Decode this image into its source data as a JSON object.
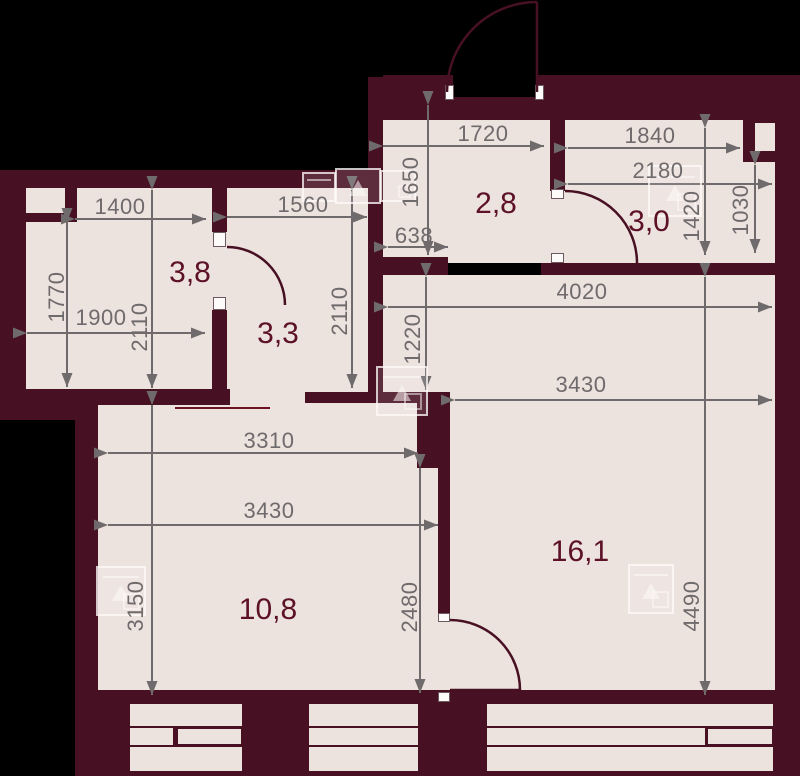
{
  "plan_title": "apartment-floor-plan",
  "colors": {
    "background": "#000000",
    "wall": "#471023",
    "room_fill": "#ece2de",
    "dimension_gray": "#6f6a6c",
    "room_label_red": "#5c1127",
    "door_frame_white": "#fdfbfa"
  },
  "rooms": {
    "r38": "3,8",
    "r33": "3,3",
    "r28": "2,8",
    "r30": "3,0",
    "r161": "16,1",
    "r108": "10,8"
  },
  "dims": {
    "d1400": "1400",
    "d1560": "1560",
    "d1900": "1900",
    "d1770": "1770",
    "d2110_a": "2110",
    "d2110_b": "2110",
    "d1720": "1720",
    "d1650": "1650",
    "d638": "638",
    "d1840": "1840",
    "d2180": "2180",
    "d1420": "1420",
    "d1030": "1030",
    "d4020": "4020",
    "d1220": "1220",
    "d3430_living": "3430",
    "d3310": "3310",
    "d3430_bedroom": "3430",
    "d3150": "3150",
    "d2480": "2480",
    "d4490": "4490"
  },
  "icons": [
    "appliance-watermark-icon-wall",
    "appliance-watermark-icon-bathroom",
    "appliance-watermark-icon-junction",
    "appliance-watermark-icon-bedroom",
    "appliance-watermark-icon-living"
  ]
}
